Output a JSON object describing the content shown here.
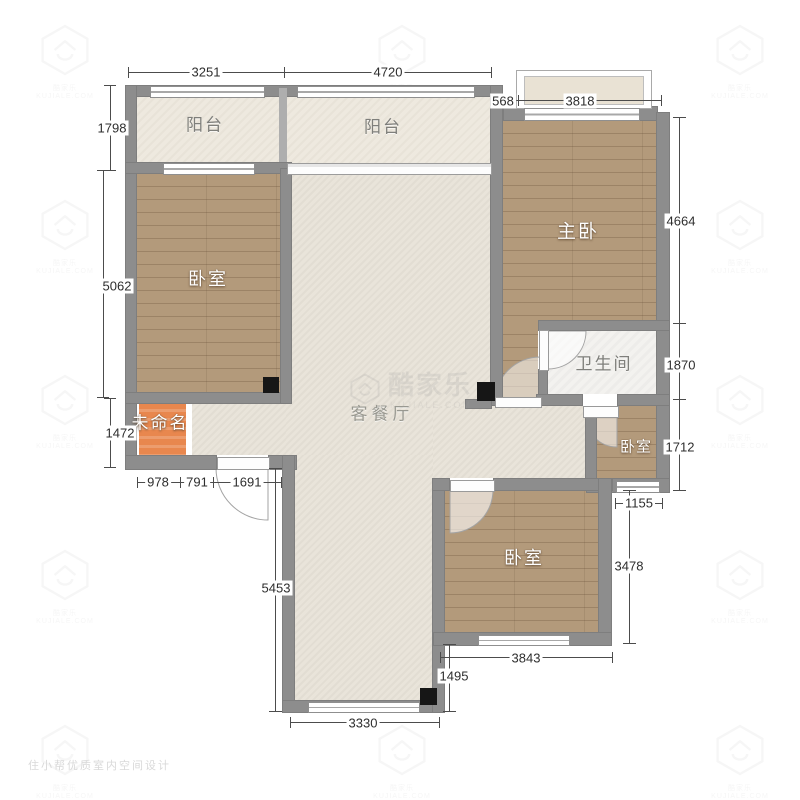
{
  "rooms": {
    "balcony_left": "阳台",
    "balcony_main": "阳台",
    "master_bedroom": "主卧",
    "bedroom_left": "卧室",
    "bathroom": "卫生间",
    "bedroom_small": "卧室",
    "bedroom_bottom": "卧室",
    "living_dining": "客餐厅",
    "unnamed": "未命名"
  },
  "dims": {
    "top_balcony_left": "3251",
    "top_balcony_main": "4720",
    "bay_offset": "568",
    "bay_width": "3818",
    "balcony_height": "1798",
    "bedroom_left_height": "5062",
    "unnamed_height": "1472",
    "entry_seg_a": "978",
    "entry_seg_b": "791",
    "entry_seg_c": "1691",
    "master_height": "4664",
    "bathroom_height": "1870",
    "bedroom_small_height": "1712",
    "bedroom_small_width": "1155",
    "bedroom_bottom_height": "3478",
    "bedroom_bottom_width": "3843",
    "living_notch": "1495",
    "living_lower_height": "5453",
    "living_lower_width": "3330"
  },
  "watermark": {
    "brand": "酷家乐",
    "site": "KUJIALE.COM",
    "tile_text": "酷家乐 KUJIALE.COM",
    "footer": "住小帮优质室内空间设计"
  },
  "colors": {
    "wall": "#8d8d8d",
    "wood_floor": "#b39a7b",
    "light_floor": "#e9e4da",
    "bathroom_floor": "#f3f2ef",
    "unnamed_floor": "#e8874e",
    "pillar": "#161616",
    "dimension_text": "#2e2e2e"
  }
}
